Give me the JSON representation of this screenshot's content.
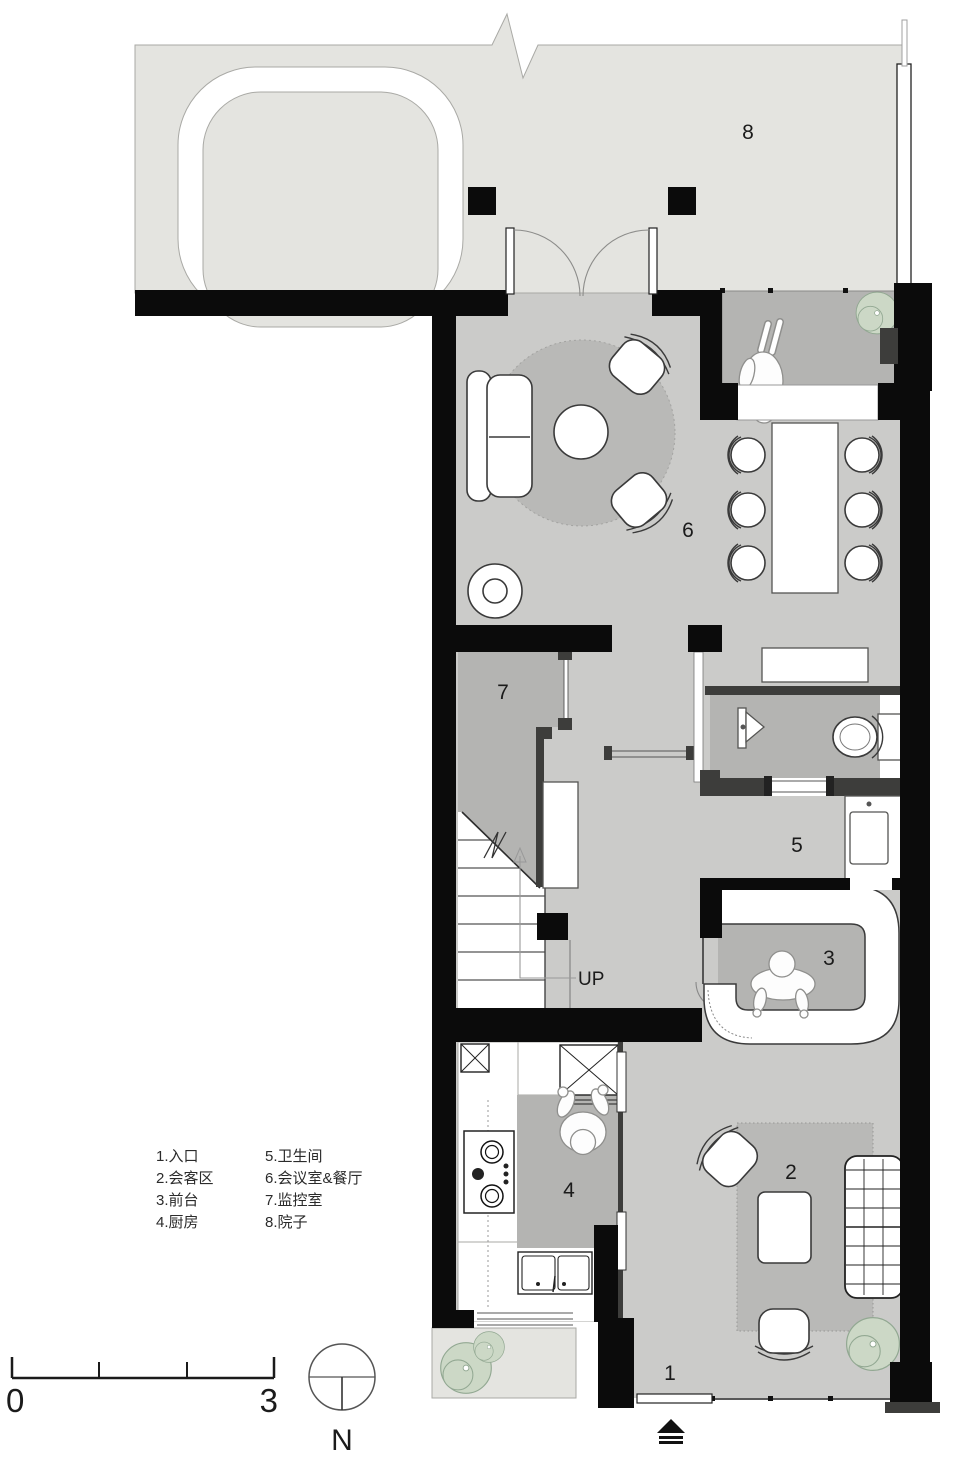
{
  "plan": {
    "room_numbers": {
      "r1": "1",
      "r2": "2",
      "r3": "3",
      "r4": "4",
      "r5": "5",
      "r6": "6",
      "r7": "7",
      "r8": "8"
    },
    "up_label": "UP",
    "north_label": "N",
    "scale_start": "0",
    "scale_end": "3"
  },
  "legend": {
    "column1": [
      "1.入口",
      "2.会客区",
      "3.前台",
      "4.厨房"
    ],
    "column2": [
      "5.卫生间",
      "6.会议室&餐厅",
      "7.监控室",
      "8.院子"
    ]
  },
  "colors": {
    "wall": "#0b0b0b",
    "wall_secondary": "#3d3d3b",
    "courtyard_floor": "#e4e4e0",
    "interior_floor": "#cbcbc9",
    "secondary_floor": "#b4b4b2",
    "rug": "#b9b9b7",
    "plant": "#ccd8c6",
    "furniture": "#ffffff"
  }
}
